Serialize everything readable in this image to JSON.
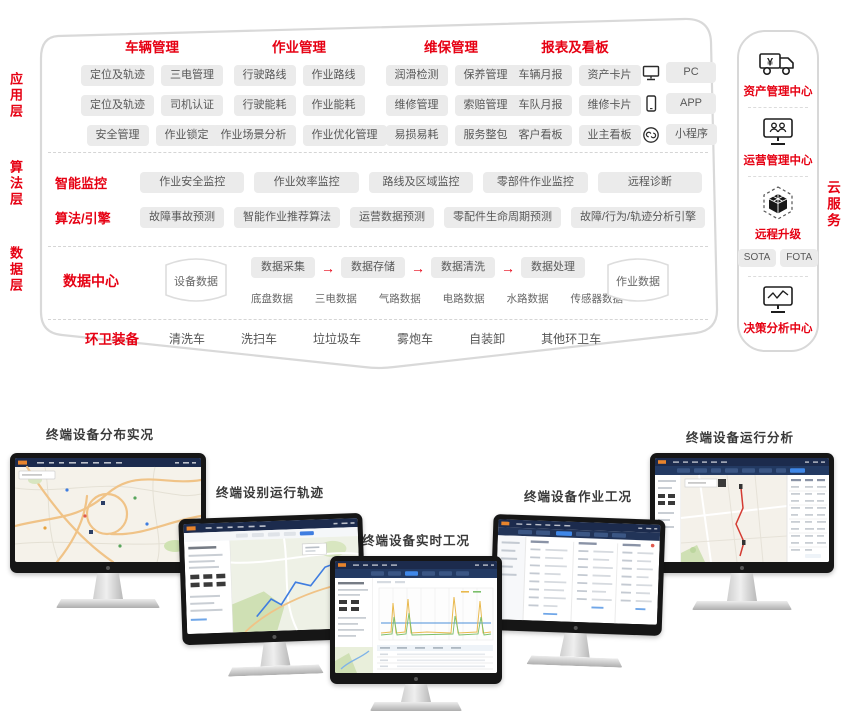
{
  "colors": {
    "accent_red": "#e60113",
    "pill_bg": "#ebebeb",
    "pill_text": "#585858",
    "frame_border": "#d8d8d8",
    "dashboard_navy": "#1c2b4d",
    "dashboard_blue": "#3f87e8",
    "map_road_orange": "#f0c387",
    "chart_yellow": "#e9b94d"
  },
  "app": {
    "layer_label": "应用层",
    "groups": [
      {
        "title": "车辆管理",
        "rows": [
          [
            "定位及轨迹",
            "三电管理"
          ],
          [
            "定位及轨迹",
            "司机认证"
          ],
          [
            "安全管理",
            "作业锁定"
          ]
        ]
      },
      {
        "title": "作业管理",
        "rows": [
          [
            "行驶路线",
            "作业路线"
          ],
          [
            "行驶能耗",
            "作业能耗"
          ],
          [
            "作业场景分析",
            "作业优化管理"
          ]
        ]
      },
      {
        "title": "维保管理",
        "rows": [
          [
            "润滑检测",
            "保养管理"
          ],
          [
            "维修管理",
            "索赔管理"
          ],
          [
            "易损易耗",
            "服务整包"
          ]
        ]
      },
      {
        "title": "报表及看板",
        "rows": [
          [
            "车辆月报",
            "资产卡片"
          ],
          [
            "车队月报",
            "维修卡片"
          ],
          [
            "客户看板",
            "业主看板"
          ]
        ]
      }
    ],
    "devices": [
      {
        "icon": "pc-icon",
        "label": "PC"
      },
      {
        "icon": "phone-icon",
        "label": "APP"
      },
      {
        "icon": "link-icon",
        "label": "小程序"
      }
    ]
  },
  "algo": {
    "layer_label": "算法层",
    "rows": [
      {
        "title": "智能监控",
        "items": [
          "作业安全监控",
          "作业效率监控",
          "路线及区域监控",
          "零部件作业监控",
          "远程诊断"
        ]
      },
      {
        "title": "算法/引擎",
        "items": [
          "故障事故预测",
          "智能作业推荐算法",
          "运营数据预测",
          "零配件生命周期预测",
          "故障/行为/轨迹分析引擎"
        ]
      }
    ]
  },
  "data_layer": {
    "layer_label": "数据层",
    "title": "数据中心",
    "left_store": "设备数据",
    "right_store": "作业数据",
    "arrow": "→",
    "flow": [
      "数据采集",
      "数据存储",
      "数据清洗",
      "数据处理"
    ],
    "sources": [
      "底盘数据",
      "三电数据",
      "气路数据",
      "电路数据",
      "水路数据",
      "传感器数据"
    ]
  },
  "equipment": {
    "title": "环卫装备",
    "items": [
      "清洗车",
      "洗扫车",
      "垃垃圾车",
      "雾炮车",
      "自装卸",
      "其他环卫车"
    ]
  },
  "cloud": {
    "side_label": "云服务",
    "items": [
      {
        "icon": "truck-yuan-icon",
        "label": "资产管理中心"
      },
      {
        "icon": "monitor-users-icon",
        "label": "运营管理中心"
      },
      {
        "icon": "cube-icon",
        "label": "远程升级",
        "badges": [
          "SOTA",
          "FOTA"
        ]
      },
      {
        "icon": "monitor-chart-icon",
        "label": "决策分析中心"
      }
    ]
  },
  "monitors": [
    {
      "caption": "终端设备分布实况"
    },
    {
      "caption": "终端设别运行轨迹"
    },
    {
      "caption": "终端设备实时工况"
    },
    {
      "caption": "终端设备作业工况"
    },
    {
      "caption": "终端设备运行分析"
    }
  ]
}
